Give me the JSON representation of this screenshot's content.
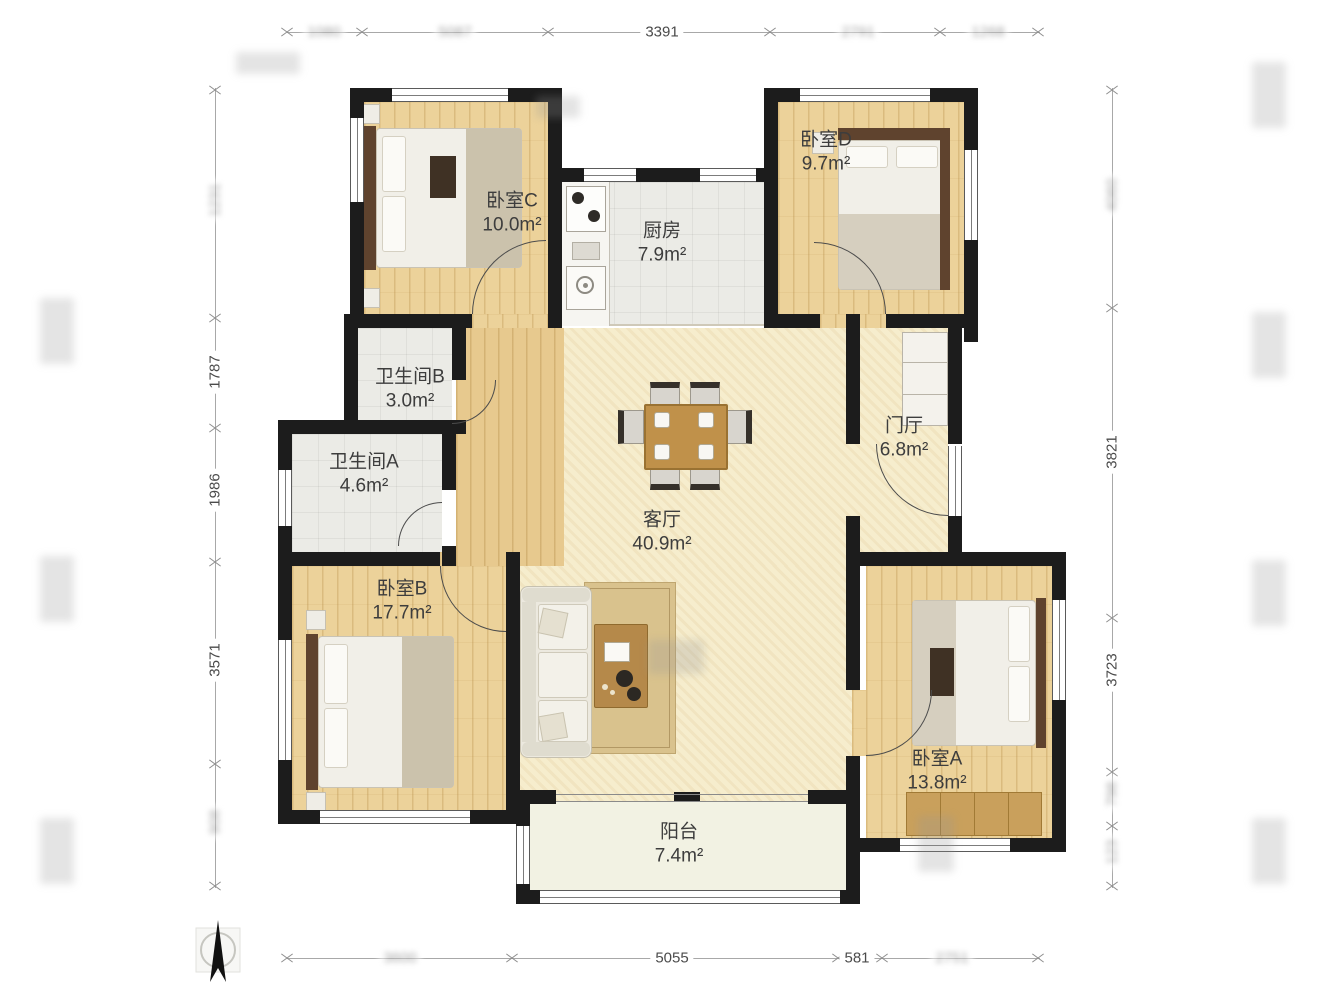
{
  "title": "residential-floor-plan",
  "rooms": [
    {
      "name": "卧室C",
      "area": "10.0m²"
    },
    {
      "name": "厨房",
      "area": "7.9m²"
    },
    {
      "name": "卧室D",
      "area": "9.7m²"
    },
    {
      "name": "卫生间B",
      "area": "3.0m²"
    },
    {
      "name": "卫生间A",
      "area": "4.6m²"
    },
    {
      "name": "门厅",
      "area": "6.8m²"
    },
    {
      "name": "客厅",
      "area": "40.9m²"
    },
    {
      "name": "卧室B",
      "area": "17.7m²"
    },
    {
      "name": "卧室A",
      "area": "13.8m²"
    },
    {
      "name": "阳台",
      "area": "7.4m²"
    }
  ],
  "dimensions": {
    "top": [
      {
        "value": "1080"
      },
      {
        "value": "5087"
      },
      {
        "value": "3391"
      },
      {
        "value": "2791"
      },
      {
        "value": "1268"
      }
    ],
    "bottom": [
      {
        "value": "3600"
      },
      {
        "value": "5055"
      },
      {
        "value": "581"
      },
      {
        "value": "2751"
      }
    ],
    "left": [
      {
        "value": "1231"
      },
      {
        "value": "1787"
      },
      {
        "value": "1986"
      },
      {
        "value": "3571"
      },
      {
        "value": "908"
      }
    ],
    "right": [
      {
        "value": "4060"
      },
      {
        "value": "3821"
      },
      {
        "value": "3723"
      },
      {
        "value": "798"
      },
      {
        "value": "123"
      }
    ]
  },
  "colors": {
    "wall": "#1c1c1c",
    "bedroom_floor": "#ecd29a",
    "living_floor": "#f6edcd",
    "tile_floor": "#ebebe6",
    "balcony_floor": "#f2f2e3",
    "dimension_line": "#a8a8a8",
    "table_wood": "#c0914a"
  }
}
